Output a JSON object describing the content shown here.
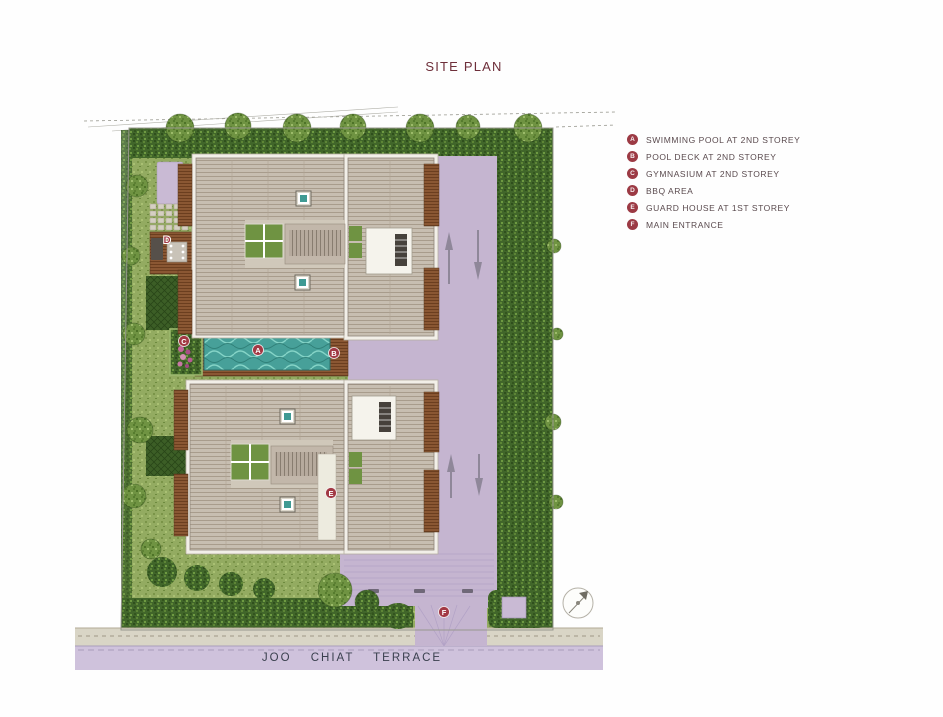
{
  "title": "SITE PLAN",
  "legend": {
    "items": [
      {
        "key": "A",
        "label": "SWIMMING POOL AT 2ND STOREY"
      },
      {
        "key": "B",
        "label": "POOL DECK AT 2ND STOREY"
      },
      {
        "key": "C",
        "label": "GYMNASIUM AT 2ND STOREY"
      },
      {
        "key": "D",
        "label": "BBQ AREA"
      },
      {
        "key": "E",
        "label": "GUARD HOUSE AT 1ST STOREY"
      },
      {
        "key": "F",
        "label": "MAIN ENTRANCE"
      }
    ]
  },
  "plan": {
    "road_name": "JOO CHIAT TERRACE"
  },
  "colors": {
    "accent_maroon": "#6e2f3a",
    "badge_red": "#9c3a44",
    "pool_teal": "#47a099",
    "driveway_lavender": "#c5b5d0",
    "roof_tan": "#c7beb1",
    "deck_brown": "#8a5733",
    "hedge_green": "#41662a",
    "grass_green": "#93ab61",
    "road_lavender": "#cfc2dc",
    "sidewalk_gray": "#d9d5c6"
  }
}
